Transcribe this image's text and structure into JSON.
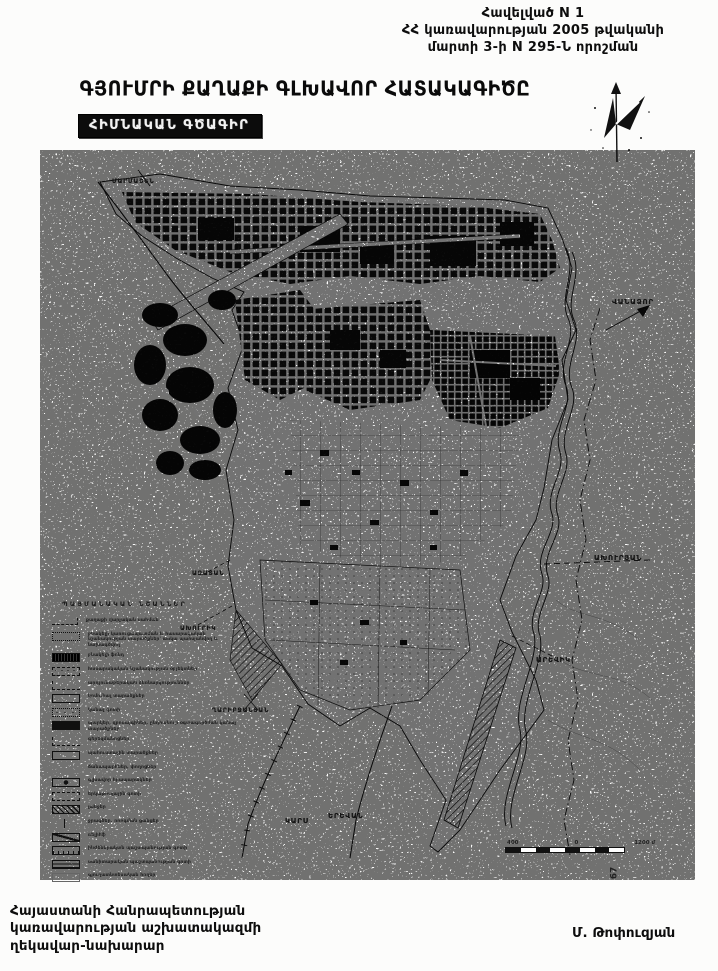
{
  "header": {
    "lines": [
      "Հավելված N 1",
      "ՀՀ կառավարության 2005 թվականի",
      "մարտի 3-ի N 295-Ն որոշման"
    ]
  },
  "title": "ԳՅՈՒՄՐԻ ՔԱՂԱՔԻ ԳԼԽԱՎՈՐ ՀԱՏԱԿԱԳԻԾԸ",
  "subtitle": "ՀԻՄՆԱԿԱՆ ԳԾԱԳԻՐ",
  "legend": {
    "title": "ՊԱՅՄԱՆԱԿԱՆ ՆՇԱՆՆԵՐ",
    "items": [
      {
        "symbol": "dashline",
        "label": "քաղաքի վարչական սահման"
      },
      {
        "symbol": "dotted",
        "label": "բնակելի կառուցապատման և հասարակական նշանակության տարածքներ՝ առկա պահպանվող և նախագծվող"
      },
      {
        "symbol": "solid",
        "label": "բնակելի ֆոնդ"
      },
      {
        "symbol": "mixdots",
        "label": "հասարակական նշանակության օբյեկտներ"
      },
      {
        "symbol": "cornerdash",
        "label": "արդյունաբերական ձեռնարկություններ"
      },
      {
        "symbol": "empty",
        "label": "կոմունալ տարածքներ"
      },
      {
        "symbol": "dotted2",
        "label": "կանաչ գոտի"
      },
      {
        "symbol": "solidglyph",
        "label": "պարկեր, զբոսայգիներ, ընդհանուր օգտագործման կանաչ տարածքներ"
      },
      {
        "symbol": "cornerdash",
        "label": "գերեզմանոցներ"
      },
      {
        "symbol": "empty",
        "label": "պահուստային տարածքներ"
      },
      {
        "symbol": "none",
        "label": "ճանապարհներ, փողոցներ"
      },
      {
        "symbol": "circle",
        "label": "գլխավոր հրապարակներ"
      },
      {
        "symbol": "dashed",
        "label": "երկաթուղային գոտի"
      },
      {
        "symbol": "hatch",
        "label": "լանջեր"
      },
      {
        "symbol": "thinline",
        "label": "ջրագծեր, ոռոգման ցանցեր"
      },
      {
        "symbol": "curve",
        "label": "ռելիեֆ"
      },
      {
        "symbol": "ticks",
        "label": "ինժեներական պաշտպանության գոտի"
      },
      {
        "symbol": "hlines",
        "label": "սանիտարական պաշտպանության գոտի"
      },
      {
        "symbol": "light",
        "label": "գյուղատնտեսական հողեր"
      }
    ]
  },
  "map_labels": [
    {
      "text": "ՄԱՐՄԱՇԵՆ",
      "x": 112,
      "y": 178,
      "size": 6
    },
    {
      "text": "ՎԱՆԱՁՈՐ",
      "x": 612,
      "y": 298,
      "size": 7
    },
    {
      "text": "ԱԽՈՒՐՅԱՆ",
      "x": 594,
      "y": 554,
      "size": 7
    },
    {
      "text": "ԱՐԵՎԻԿ",
      "x": 536,
      "y": 656,
      "size": 7
    },
    {
      "text": "ԱԶԱՏԱՆ",
      "x": 192,
      "y": 570,
      "size": 6
    },
    {
      "text": "ԱԽՈՒՐԻԿ",
      "x": 180,
      "y": 625,
      "size": 6
    },
    {
      "text": "ՂԱՐԻԲՋԱՆՅԱՆ",
      "x": 212,
      "y": 707,
      "size": 6
    },
    {
      "text": "ԿԱՐՍ",
      "x": 285,
      "y": 817,
      "size": 7
    },
    {
      "text": "ԵՐԵՎԱՆ",
      "x": 328,
      "y": 812,
      "size": 7
    }
  ],
  "scale_bar": {
    "left": "400",
    "mid": "0",
    "right": "1200 մ"
  },
  "page_number": "67",
  "footer": {
    "lines": [
      "Հայաստանի Հանրապետության",
      "կառավարության աշխատակազմի",
      "ղեկավար-նախարար"
    ],
    "signature": "Մ. Թոփուզյան"
  },
  "colors": {
    "ink": "#111111",
    "paper": "#fcfcfb"
  }
}
